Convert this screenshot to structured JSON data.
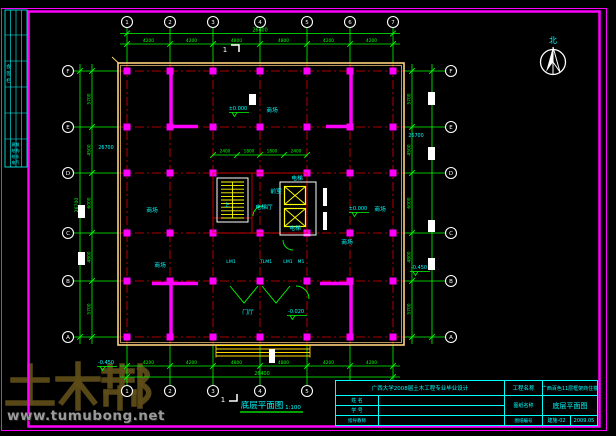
{
  "colors": {
    "bg": "#000000",
    "frame": "#FF00FF",
    "grid": "#E00000",
    "dim": "#00FF00",
    "outline": "#FFD27E",
    "core": "#FFFF00",
    "label": "#00FFFF",
    "wall": "#FF00FF",
    "white": "#FFFFFF",
    "logo": "#5E4C18",
    "url_gray": "#9A9A9A"
  },
  "watermark": {
    "logo": "土木帮",
    "url": "www.tumubong.net"
  },
  "north_label": "北",
  "plan_title": {
    "text": "底层平面图",
    "scale": "1:100"
  },
  "axes": {
    "vertical": [
      {
        "label": "1",
        "x": 127
      },
      {
        "label": "2",
        "x": 170
      },
      {
        "label": "3",
        "x": 213
      },
      {
        "label": "4",
        "x": 260
      },
      {
        "label": "5",
        "x": 307
      },
      {
        "label": "6",
        "x": 350
      },
      {
        "label": "7",
        "x": 393
      }
    ],
    "horizontal": [
      {
        "label": "F",
        "y": 71
      },
      {
        "label": "E",
        "y": 127
      },
      {
        "label": "D",
        "y": 173
      },
      {
        "label": "C",
        "y": 233
      },
      {
        "label": "B",
        "y": 281
      },
      {
        "label": "A",
        "y": 337
      }
    ]
  },
  "dimensions": {
    "top_segments": [
      "4200",
      "4200",
      "4800",
      "4800",
      "4200",
      "4200"
    ],
    "top_total": "26400",
    "bottom_segments": [
      "4200",
      "4200",
      "4800",
      "4800",
      "4200",
      "4200"
    ],
    "bottom_total": "26400",
    "left_segments": [
      "5700",
      "4500",
      "6000",
      "4800",
      "5700"
    ],
    "left_total": "26700",
    "right_segments": [
      "5700",
      "4500",
      "6000",
      "4800",
      "5700"
    ],
    "right_total": "26700",
    "inner_top": [
      "2400",
      "1800",
      "1800",
      "2400"
    ]
  },
  "rooms": [
    {
      "text": "商场",
      "x": 272,
      "y": 112
    },
    {
      "text": "商场",
      "x": 152,
      "y": 212
    },
    {
      "text": "商场",
      "x": 160,
      "y": 267
    },
    {
      "text": "商场",
      "x": 380,
      "y": 211
    },
    {
      "text": "商场",
      "x": 347,
      "y": 244
    },
    {
      "text": "门厅",
      "x": 248,
      "y": 314
    },
    {
      "text": "电梯",
      "x": 297,
      "y": 180
    },
    {
      "text": "电梯",
      "x": 295,
      "y": 230
    },
    {
      "text": "前室",
      "x": 276,
      "y": 193
    },
    {
      "text": "电梯厅",
      "x": 264,
      "y": 209
    },
    {
      "text": "上",
      "x": 227,
      "y": 207
    }
  ],
  "elevations": [
    {
      "text": "±0.000",
      "x": 238,
      "y": 110
    },
    {
      "text": "±0.000",
      "x": 358,
      "y": 210
    },
    {
      "text": "-0.020",
      "x": 296,
      "y": 313
    },
    {
      "text": "-0.450",
      "x": 106,
      "y": 364
    },
    {
      "text": "-0.450",
      "x": 419,
      "y": 269
    }
  ],
  "misc_texts": [
    {
      "text": "26700",
      "x": 106,
      "y": 149
    },
    {
      "text": "26700",
      "x": 416,
      "y": 137
    }
  ],
  "door_tags": [
    {
      "text": "LM1",
      "x": 231,
      "y": 263
    },
    {
      "text": "TLM1",
      "x": 266,
      "y": 263
    },
    {
      "text": "LM1",
      "x": 288,
      "y": 263
    },
    {
      "text": "M1",
      "x": 301,
      "y": 263
    }
  ],
  "section_mark": "1",
  "signature_strip": {
    "title": "会签栏",
    "cells": [
      "建筑",
      "结构",
      "给水",
      "电气"
    ]
  },
  "title_block": {
    "school": "广西大学2008届土木工程专业毕业设计",
    "project_label": "工程名称",
    "project_name": "广西百色11层框架商住楼",
    "name_label": "姓 名",
    "id_label": "学 号",
    "advisor_label": "指导教师",
    "sheet_label": "图纸名称",
    "sheet_name": "底层平面图",
    "no_label": "图纸编号",
    "sheet_no": "建施-02",
    "date": "2009.05"
  }
}
